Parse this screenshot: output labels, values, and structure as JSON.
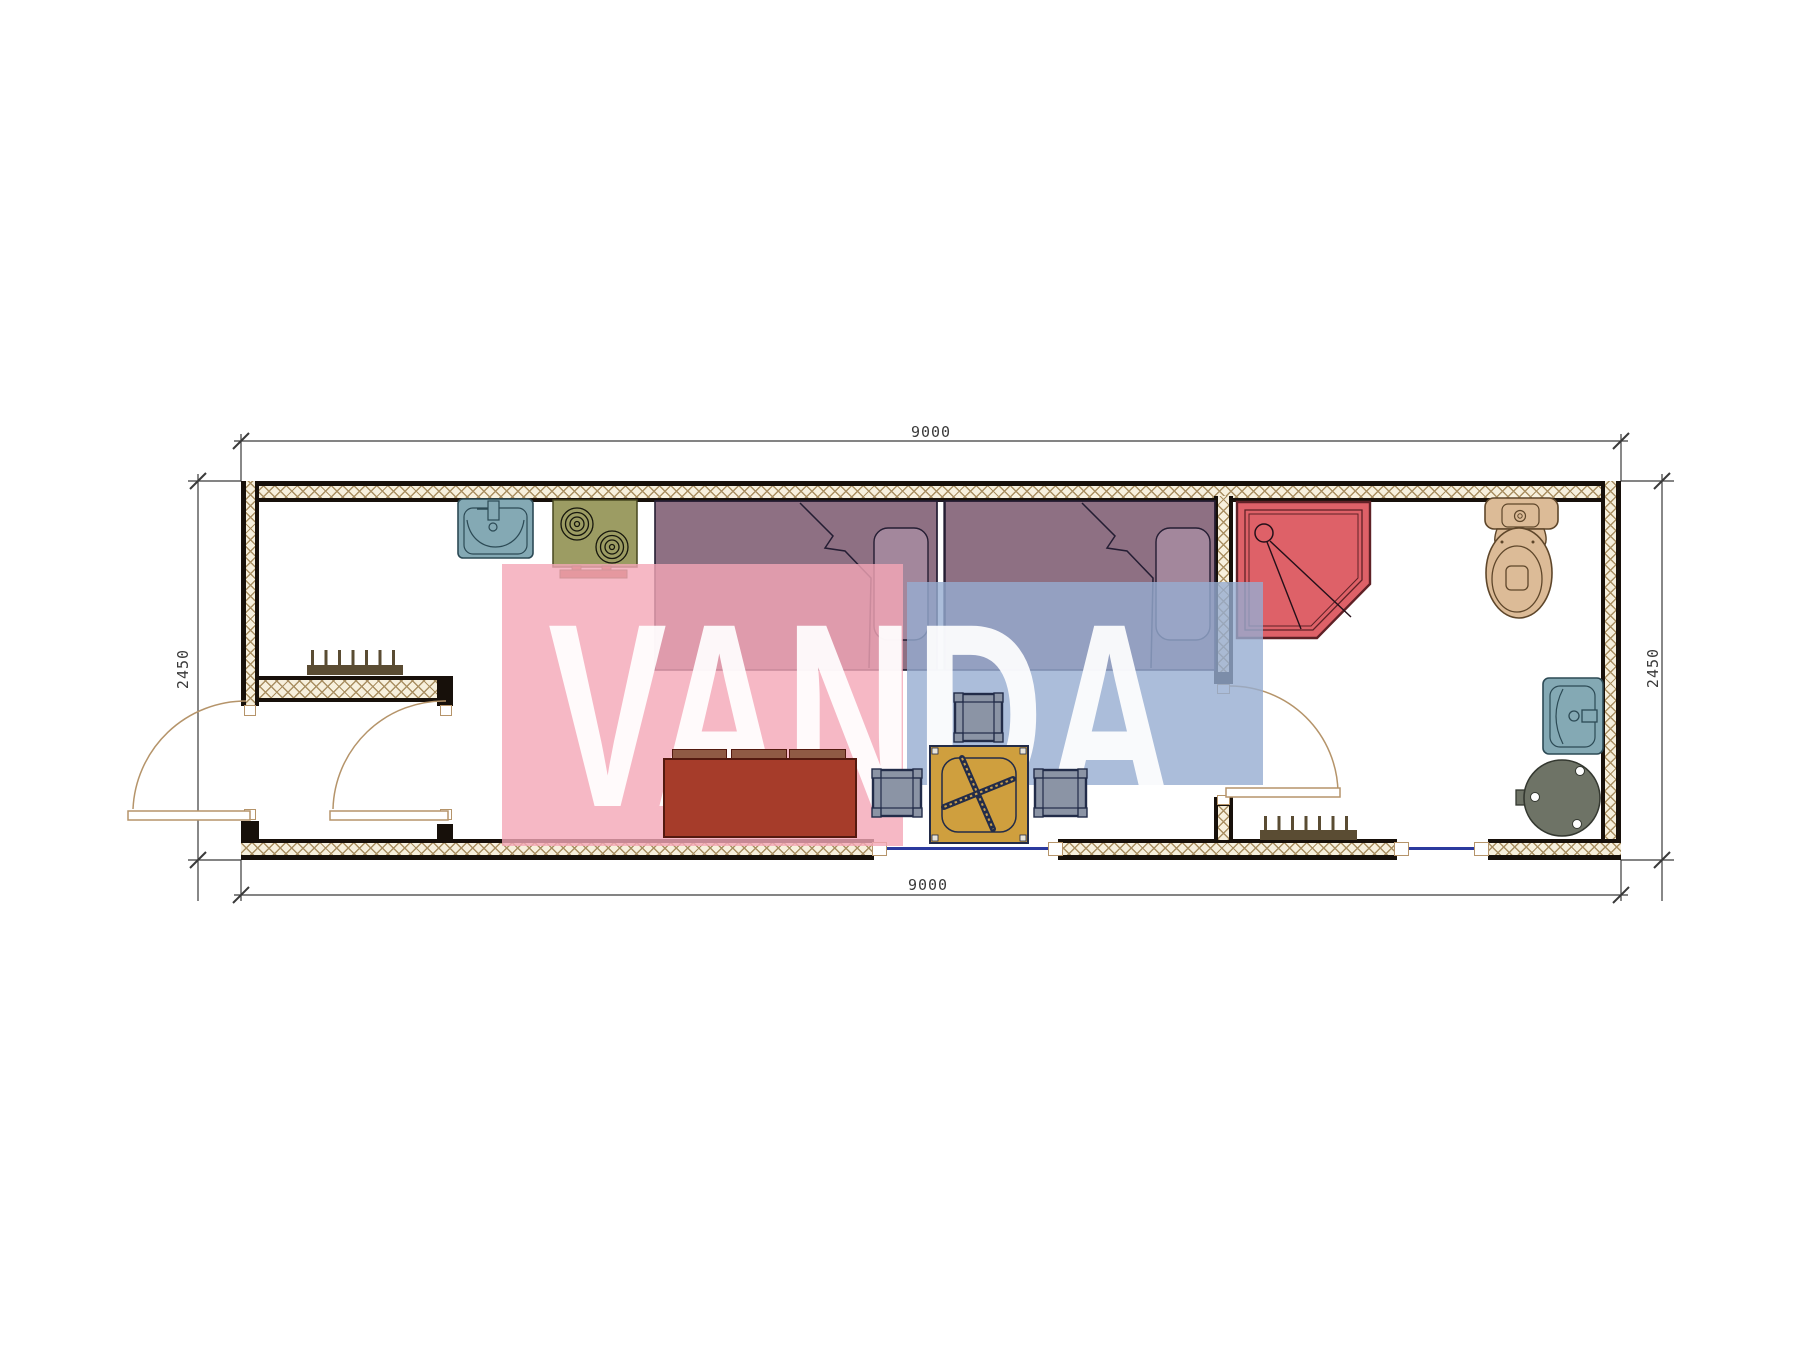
{
  "watermark": {
    "text": "VANDA"
  },
  "dimensions": {
    "top": "9000",
    "bottom": "9000",
    "left": "2450",
    "right": "2450"
  },
  "plan": {
    "type": "container-house-floor-plan",
    "rooms": [
      "entry-vestibule",
      "kitchen-living-bedroom",
      "bathroom"
    ],
    "fixtures": [
      "kitchen-sink",
      "stove-2-burner",
      "bed-1",
      "bed-2",
      "shower-cabin",
      "toilet",
      "wash-basin",
      "water-boiler",
      "sofa",
      "folding-table",
      "stool-1",
      "stool-2",
      "stool-3",
      "radiator-hall",
      "radiator-bath"
    ],
    "openings": [
      "entry-door-left-wall",
      "vestibule-interior-door",
      "bathroom-door",
      "window-living-bottom",
      "window-bathroom-bottom"
    ]
  },
  "colors": {
    "ink": "#17100a",
    "hatch-bg": "#f7f0dd",
    "hatch-line": "#a98f62",
    "dim": "#3a3a3a",
    "door": "#b5946a",
    "window": "#2b3a9e",
    "bed": "rgba(110,72,96,0.78)",
    "bed-line": "#241d33",
    "pillow": "rgba(180,154,176,0.55)",
    "shower": "#de6168",
    "shower-line": "#5e2126",
    "sink": "#84a9b4",
    "sink-line": "#2c4a55",
    "stove": "#9c9c63",
    "stove-line": "#46461f",
    "vent": "#a85f43",
    "toilet": "#dcbb97",
    "toilet-line": "#5e462a",
    "boiler": "#6e7366",
    "boiler-line": "#343830",
    "sofa": "#a63c2a",
    "sofa-line": "#54190f",
    "sofa-tab": "#8f5a44",
    "table": "#cf9f3e",
    "table-line": "#232c49",
    "table-thread": "#caa04c",
    "stool": "#8b94a5",
    "stool-line": "#222c49",
    "radiator": "#5a4c33",
    "wm-pink": "rgba(244,166,183,0.8)",
    "wm-blue": "rgba(150,173,209,0.8)",
    "wm-text": "rgba(255,255,255,0.92)"
  }
}
